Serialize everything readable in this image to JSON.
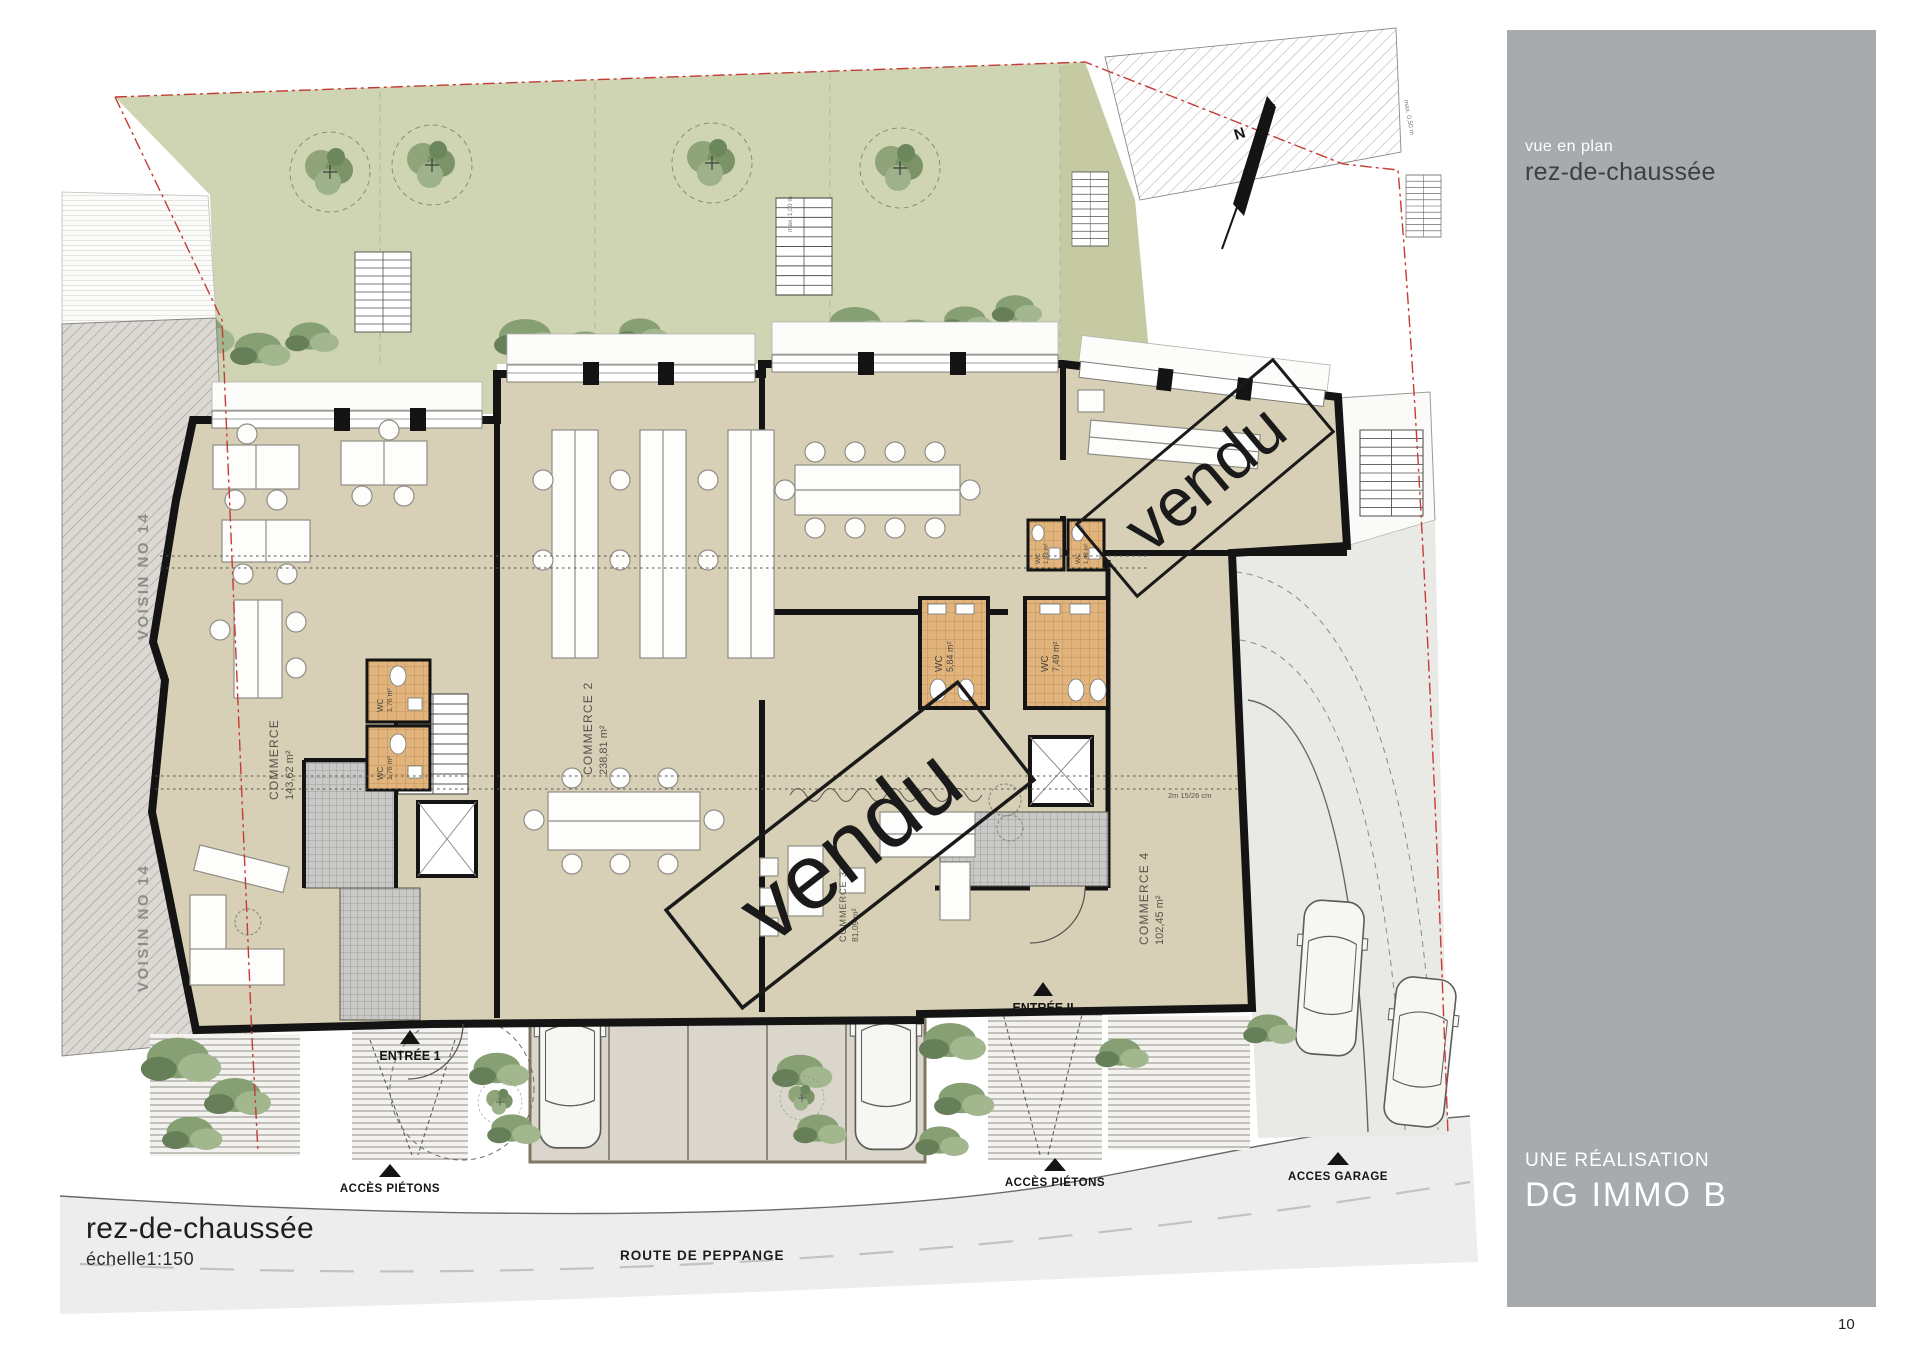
{
  "page": {
    "number": "10"
  },
  "sidebar": {
    "subtitle": "vue en plan",
    "title": "rez-de-chaussée",
    "footer_label": "UNE RÉALISATION",
    "footer_brand": "DG IMMO B"
  },
  "title_block": {
    "title": "rez-de-chaussée",
    "scale": "échelle1:150"
  },
  "road": {
    "name": "ROUTE DE PEPPANGE"
  },
  "plan": {
    "north": {
      "label": "N"
    },
    "neighbors": [
      {
        "label": "VOISIN NO 14"
      },
      {
        "label": "VOISIN NO 14"
      }
    ],
    "rooms": [
      {
        "name": "COMMERCE",
        "area": "143,62 m²"
      },
      {
        "name": "COMMERCE 2",
        "area": "238,81 m²"
      },
      {
        "name": "COMMERCE 3",
        "area": "81,09 m²"
      },
      {
        "name": "COMMERCE 4",
        "area": "102,45 m²"
      }
    ],
    "wcs": [
      {
        "label": "WC",
        "area": "1,76 m²"
      },
      {
        "label": "WC",
        "area": "1,76 m²"
      },
      {
        "label": "WC",
        "area": "5,84 m²"
      },
      {
        "label": "WC",
        "area": "7,49 m²"
      },
      {
        "label": "WC",
        "area": "1,93 m²"
      },
      {
        "label": "WC",
        "area": "1,48 m²"
      }
    ],
    "stamps": [
      {
        "text": "vendu"
      },
      {
        "text": "vendu"
      }
    ],
    "entrances": [
      {
        "label": "ENTRÉE 1"
      },
      {
        "label": "ENTRÉE II"
      }
    ],
    "access": [
      {
        "label": "ACCÈS PIÉTONS"
      },
      {
        "label": "ACCÈS PIÉTONS"
      },
      {
        "label": "ACCES GARAGE"
      }
    ],
    "parking": {
      "spaces": [
        "1",
        "2",
        "3",
        "4",
        "5"
      ]
    },
    "dimensions": [
      {
        "label": "max. 1,00 m"
      },
      {
        "label": "max. 0,50 m"
      },
      {
        "label": "2m 15/26 cm"
      }
    ]
  },
  "colors": {
    "sidebar_bg": "#a7abad",
    "room_fill": "#d8d0b6",
    "garden_fill": "#cfd4b2",
    "garden_right_fill": "#c6caa3",
    "wc_tile": "#e0b47c",
    "stair_tile": "#c9c9c7",
    "boundary_red": "#c43c35",
    "road_fill": "#ededed",
    "wall_black": "#141414",
    "parking_fill": "#dad6cb"
  }
}
